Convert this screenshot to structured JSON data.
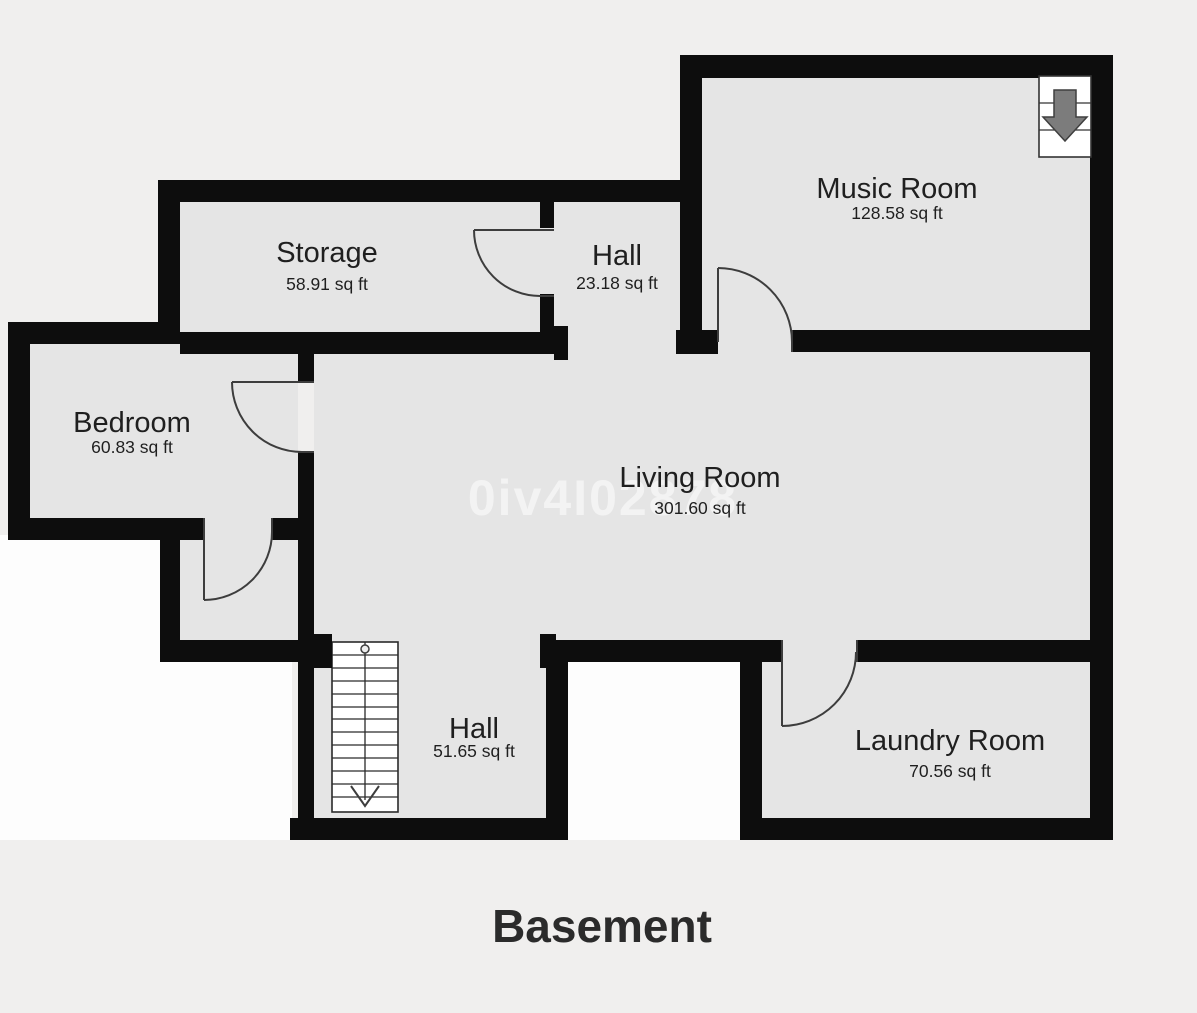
{
  "title": "Basement",
  "watermark": "0iv4I02878",
  "rooms": [
    {
      "name": "Storage",
      "area": "58.91 sq ft"
    },
    {
      "name": "Hall",
      "area": "23.18 sq ft"
    },
    {
      "name": "Music Room",
      "area": "128.58 sq ft"
    },
    {
      "name": "Bedroom",
      "area": "60.83 sq ft"
    },
    {
      "name": "Living Room",
      "area": "301.60 sq ft"
    },
    {
      "name": "Hall",
      "area": "51.65 sq ft"
    },
    {
      "name": "Laundry Room",
      "area": "70.56 sq ft"
    }
  ],
  "icons": [
    {
      "name": "stairs-down-icon",
      "meaning": "staircase leading down"
    },
    {
      "name": "down-arrow-icon",
      "meaning": "direction of stairs: down"
    }
  ],
  "colors": {
    "wall": "#0d0d0d",
    "floor": "#e5e5e5",
    "canvas": "#f0efee",
    "outside_patch": "#fdfdfd",
    "stair_arrow": "#7c7c7c",
    "watermark": "#ffffff",
    "title_text": "#2b2b2b"
  }
}
